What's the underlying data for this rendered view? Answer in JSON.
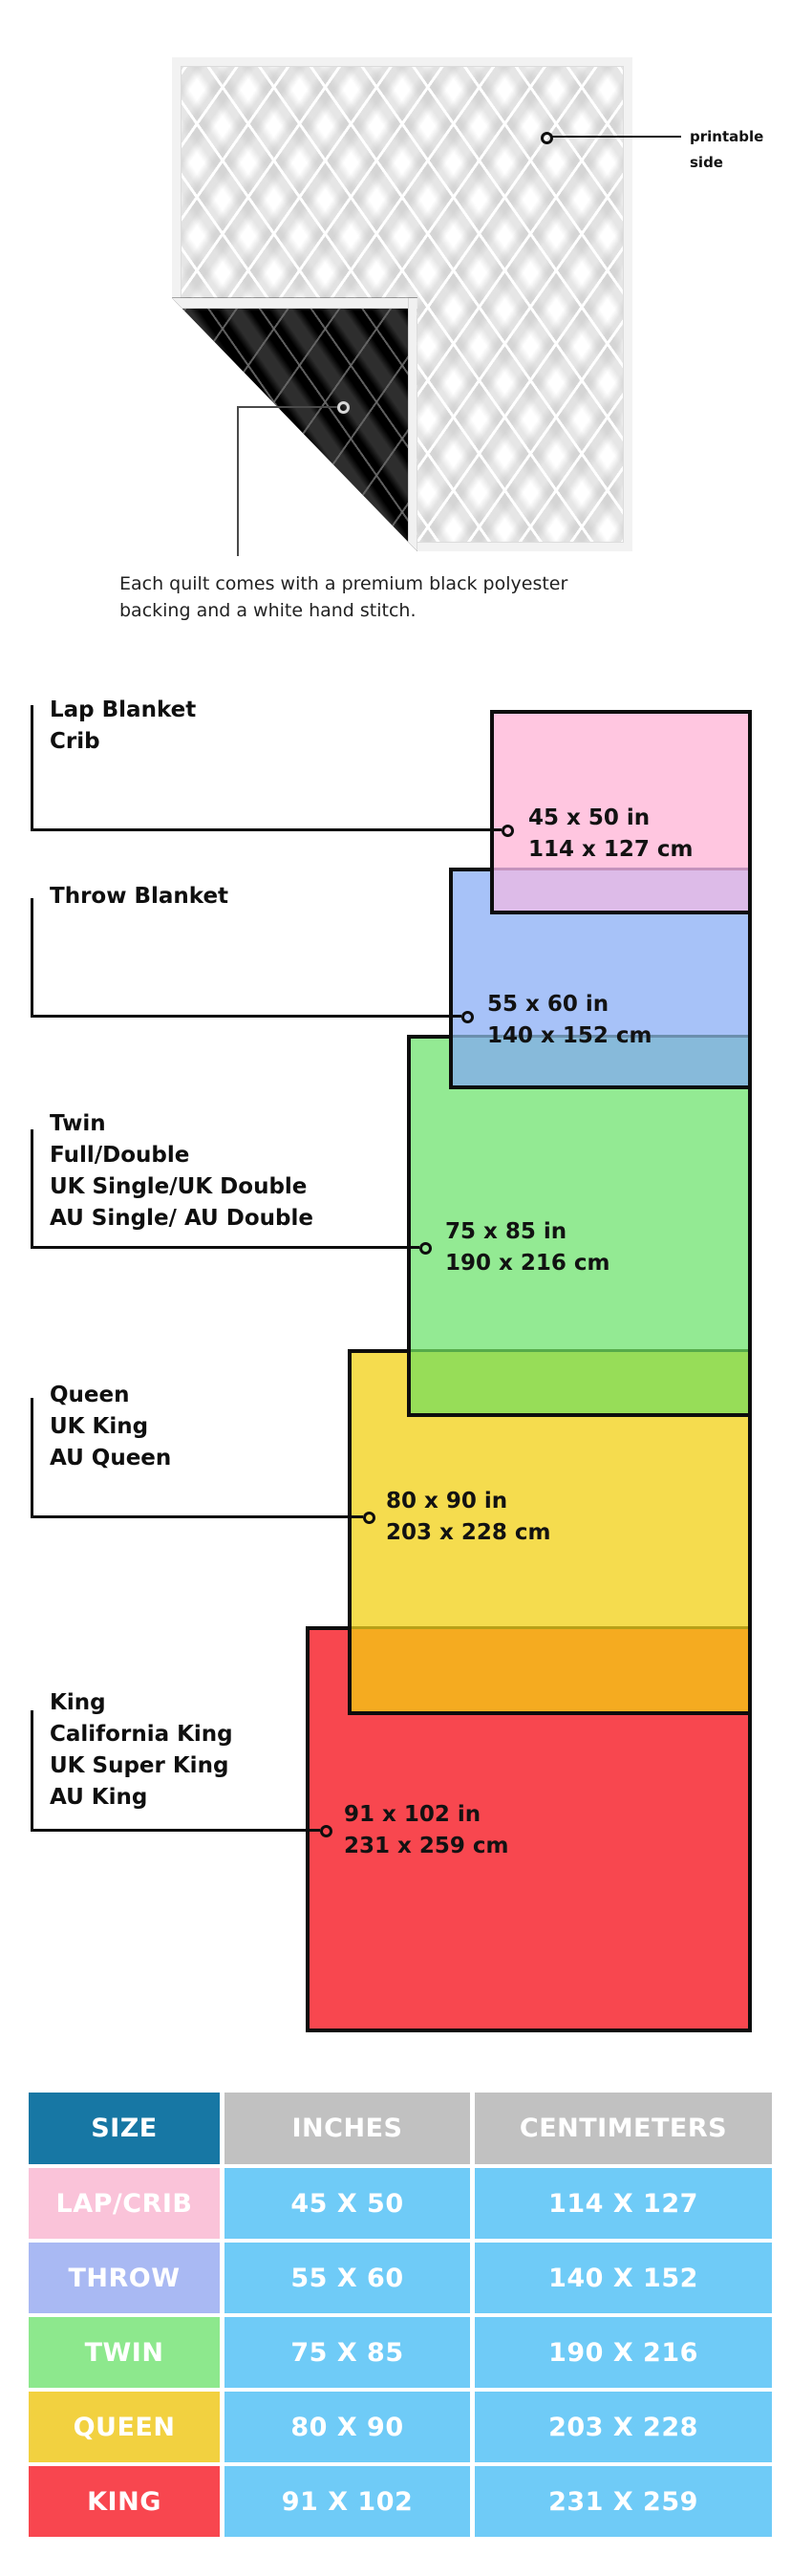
{
  "hero": {
    "printable_label_lines": [
      "printable",
      "side"
    ],
    "caption_lines": [
      "Each quilt comes with a premium black polyester",
      "backing and a white hand stitch."
    ]
  },
  "diagram": {
    "sizes": [
      {
        "id": "lap",
        "labels": [
          "Lap Blanket",
          "Crib"
        ],
        "dim_in": "45 x 50 in",
        "dim_cm": "114 x 127 cm",
        "fill": "#ffc6e0",
        "overlap_fill": "#ddbbe8"
      },
      {
        "id": "throw",
        "labels": [
          "Throw Blanket"
        ],
        "dim_in": "55 x 60 in",
        "dim_cm": "140 x 152 cm",
        "fill": "#a7c2f8",
        "overlap_fill": "#87bada"
      },
      {
        "id": "twin",
        "labels": [
          "Twin",
          "Full/Double",
          "UK Single/UK Double",
          "AU Single/ AU Double"
        ],
        "dim_in": "75 x 85 in",
        "dim_cm": "190 x 216 cm",
        "fill": "#93ea93",
        "overlap_fill": "#97dd58"
      },
      {
        "id": "queen",
        "labels": [
          "Queen",
          "UK King",
          "AU Queen"
        ],
        "dim_in": "80 x 90 in",
        "dim_cm": "203 x 228 cm",
        "fill": "#f5dc4e",
        "overlap_fill": "#f5ab20"
      },
      {
        "id": "king",
        "labels": [
          "King",
          "California King",
          "UK Super King",
          "AU King"
        ],
        "dim_in": "91 x 102 in",
        "dim_cm": "231 x 259 cm",
        "fill": "#f8474f"
      }
    ]
  },
  "table": {
    "headers": [
      "SIZE",
      "INCHES",
      "CENTIMETERS"
    ],
    "header_colors": {
      "size_bg": "#1777a4",
      "metric_bg": "#c1c1c1",
      "value_bg": "#6fcbf7"
    },
    "rows": [
      {
        "size": "LAP/CRIB",
        "inches": "45 X 50",
        "cm": "114 X 127",
        "color": "#fac3d9"
      },
      {
        "size": "THROW",
        "inches": "55 X 60",
        "cm": "140 X 152",
        "color": "#a9b9f3"
      },
      {
        "size": "TWIN",
        "inches": "75 X 85",
        "cm": "190 X 216",
        "color": "#8de88d"
      },
      {
        "size": "QUEEN",
        "inches": "80 X 90",
        "cm": "203 X 228",
        "color": "#f2d140"
      },
      {
        "size": "KING",
        "inches": "91 X 102",
        "cm": "231 X 259",
        "color": "#f8464f"
      }
    ]
  }
}
